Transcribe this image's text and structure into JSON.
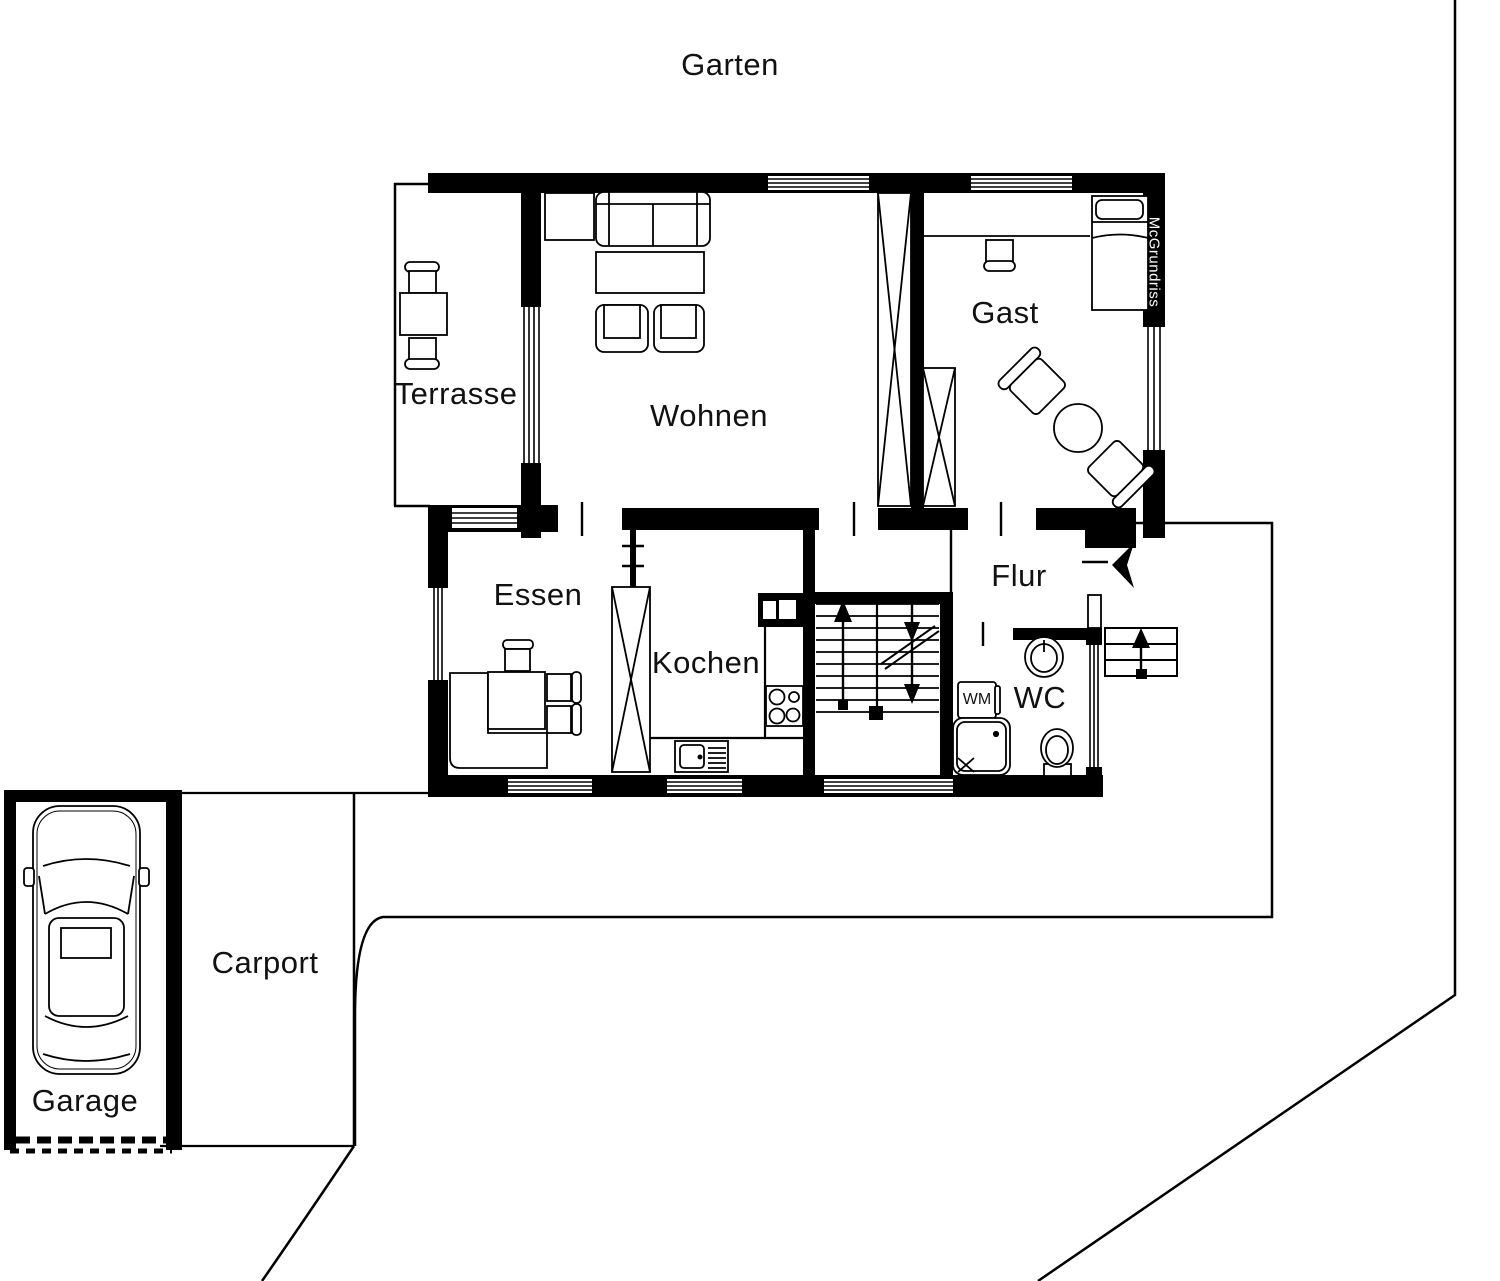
{
  "areas": {
    "garten": "Garten",
    "terrasse": "Terrasse",
    "wohnen": "Wohnen",
    "gast": "Gast",
    "essen": "Essen",
    "kochen": "Kochen",
    "flur": "Flur",
    "wc": "WC",
    "garage": "Garage",
    "carport": "Carport"
  },
  "appliance_labels": {
    "washing_machine": "WM"
  },
  "watermark": "McGrundriss",
  "colors": {
    "ink": "#000000",
    "background": "#ffffff"
  }
}
